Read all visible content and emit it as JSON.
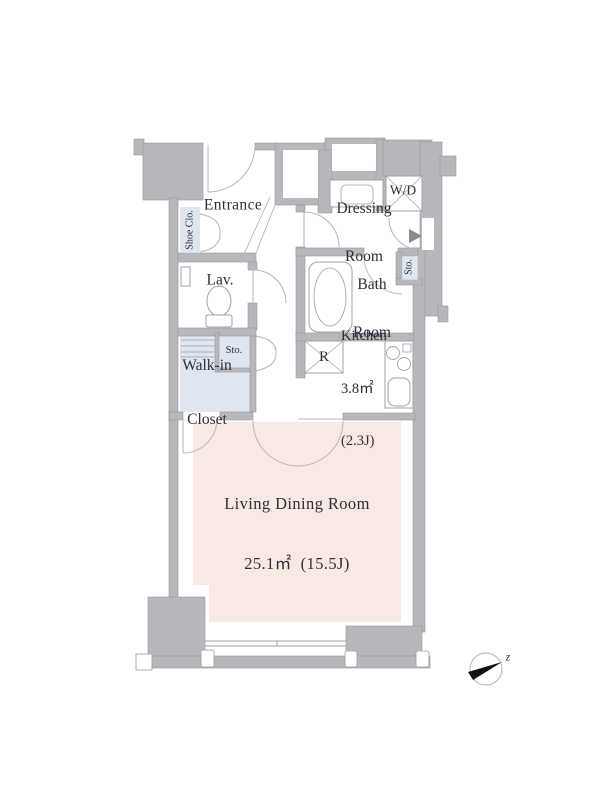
{
  "plan": {
    "type": "apartment-floor-plan",
    "colors": {
      "wall": "#b8b8bc",
      "wall_outline": "#96969c",
      "living_floor": "#f9e9e5",
      "closet_floor": "#dfe6f0",
      "fixture_line": "#a0a0a6",
      "door_line": "#b5b5ba",
      "text": "#2e2e38",
      "north_marker": "#111111"
    },
    "rooms": {
      "entrance": {
        "label": "Entrance"
      },
      "shoe_closet": {
        "label": "Shoe Clo."
      },
      "washer_dryer": {
        "label": "W/D"
      },
      "dressing_room": {
        "line1": "Dressing",
        "line2": "Room"
      },
      "storage_right": {
        "label": "Sto."
      },
      "lavatory": {
        "label": "Lav."
      },
      "bathroom": {
        "line1": "Bath",
        "line2": "Room"
      },
      "storage_hall": {
        "label": "Sto."
      },
      "walk_in_closet": {
        "line1": "Walk-in",
        "line2": "Closet"
      },
      "refrigerator_space": {
        "label": "R"
      },
      "kitchen": {
        "label": "Kitchen",
        "area_sqm": "3.8㎡",
        "area_jo": "(2.3J)"
      },
      "living_dining_room": {
        "label": "Living Dining Room",
        "area": "25.1㎡  (15.5J)"
      }
    },
    "compass": {
      "label": "z"
    }
  }
}
